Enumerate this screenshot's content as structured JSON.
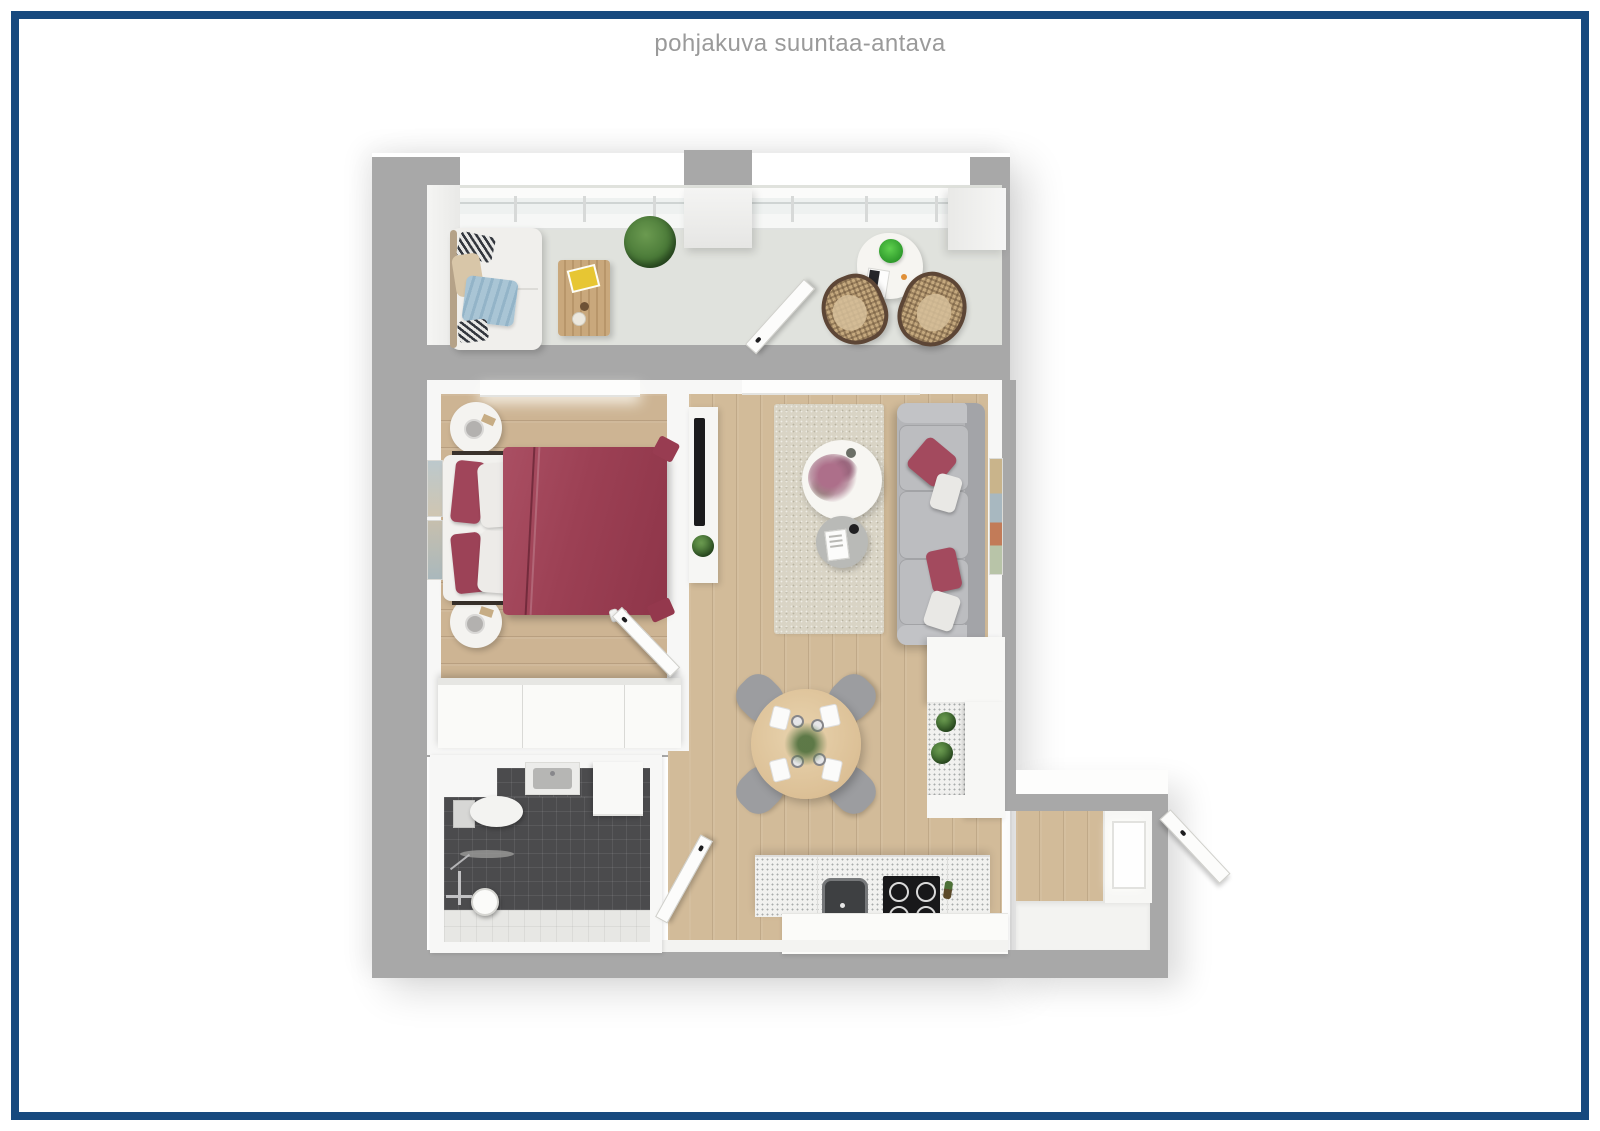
{
  "header": {
    "title": "pohjakuva suuntaa-antava"
  },
  "palette": {
    "border_navy": "#17497e",
    "title_gray": "#9a9a9a",
    "wall_gray": "#a8a8a8",
    "wood_floor": "#cdb493",
    "balcony_floor": "#e0e2dd",
    "bathroom_tile_dark": "#4b4b4d",
    "bathroom_tile_light": "#e7e7e4",
    "bed_red": "#9e4156",
    "sofa_gray": "#b4b5b8",
    "rug_beige": "#d9d4c5",
    "dining_table_wood": "#e2cba6",
    "plant_green": "#4a7a38"
  },
  "plan": {
    "type": "apartment-floor-plan-3d-top-view",
    "rooms": [
      {
        "name": "balcony",
        "furniture": [
          "outdoor-sofa",
          "coffee-table",
          "plant",
          "side-table",
          "two-wicker-chairs",
          "balcony-door"
        ]
      },
      {
        "name": "bedroom",
        "furniture": [
          "double-bed-red-duvet",
          "two-round-nightstands",
          "wall-art",
          "wardrobe",
          "window",
          "door"
        ]
      },
      {
        "name": "living-room",
        "furniture": [
          "gray-sofa-red-pillows",
          "rug",
          "round-coffee-table-flowers",
          "round-side-table",
          "tv-stand",
          "wall-art"
        ]
      },
      {
        "name": "kitchen-dining",
        "furniture": [
          "round-dining-table-four-chairs",
          "kitchen-counter-sink-cooktop",
          "kitchen-island",
          "tall-cabinets",
          "plants"
        ]
      },
      {
        "name": "bathroom",
        "furniture": [
          "toilet",
          "washbasin",
          "washer-counter",
          "shower",
          "shelf",
          "door"
        ]
      },
      {
        "name": "entry",
        "furniture": [
          "front-door",
          "window"
        ]
      }
    ]
  }
}
